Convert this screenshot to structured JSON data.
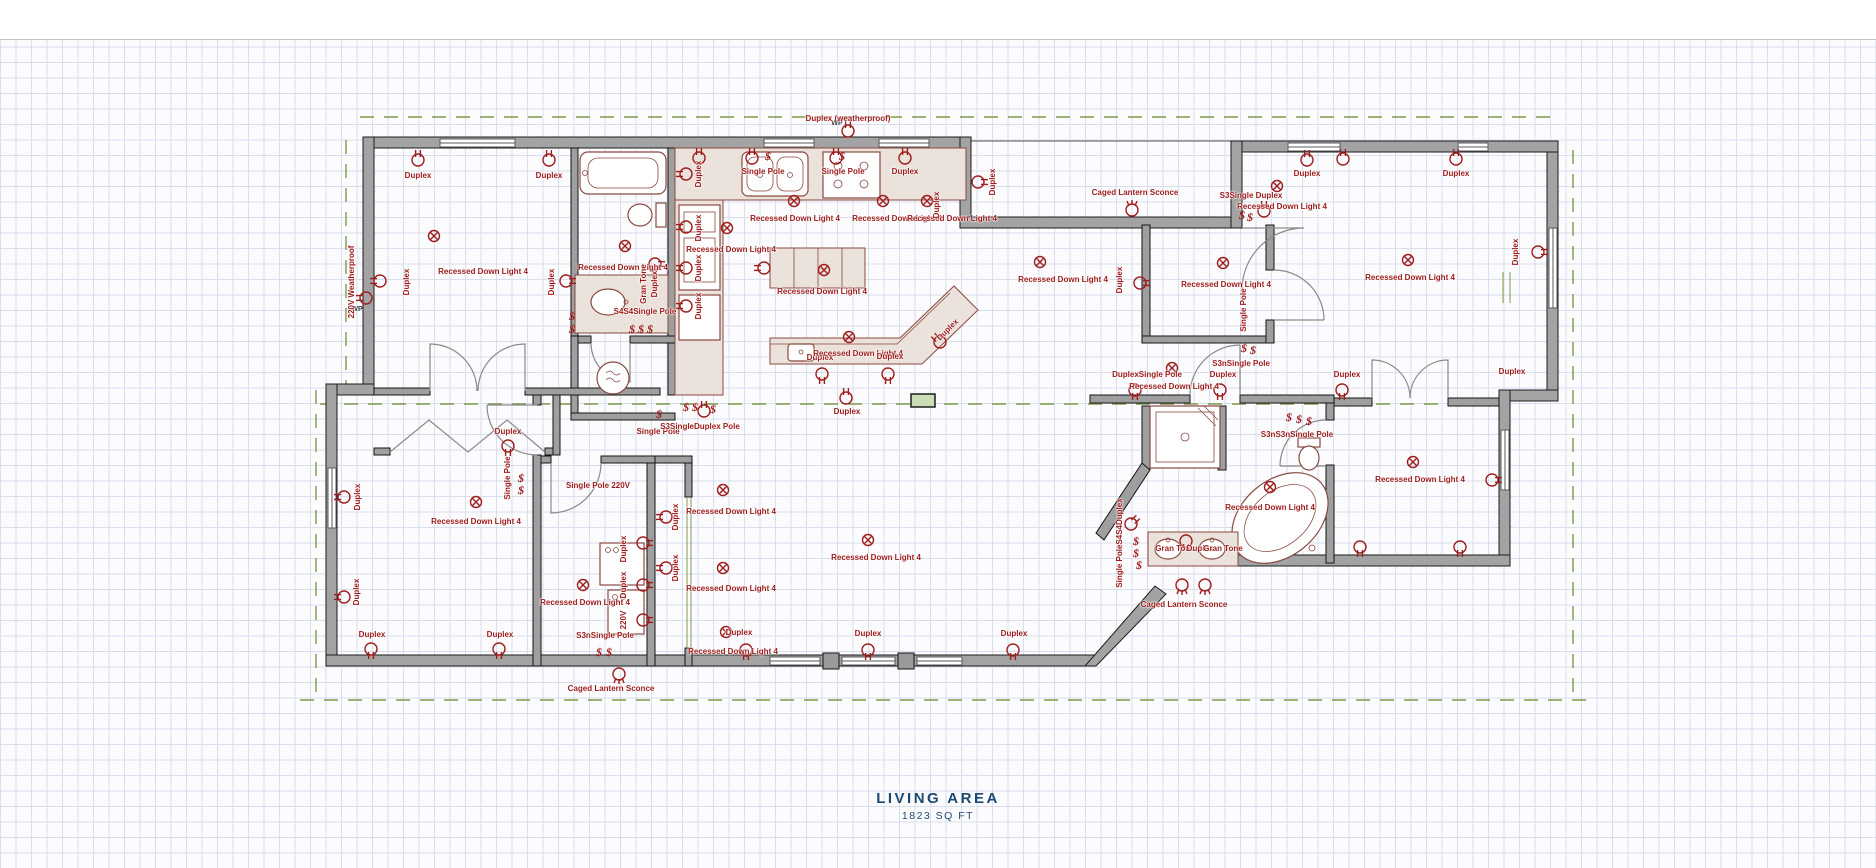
{
  "title": {
    "name": "LIVING AREA",
    "area": "1823 SQ FT"
  },
  "colors": {
    "annotation": "#9e1b1b",
    "title_blue": "#1d4a74",
    "wall_gray": "#a3a3a3",
    "grid": "#d9deec",
    "green_dash": "#7f9a48",
    "counter": "#eae2db"
  },
  "labels": [
    {
      "t": "Duplex",
      "x": 418,
      "y": 176,
      "r": 0
    },
    {
      "t": "Duplex",
      "x": 549,
      "y": 176,
      "r": 0
    },
    {
      "t": "Recessed Down Light 4",
      "x": 483,
      "y": 272,
      "r": 0
    },
    {
      "t": "Duplex",
      "x": 407,
      "y": 282,
      "r": -90
    },
    {
      "t": "Duplex",
      "x": 552,
      "y": 282,
      "r": -90
    },
    {
      "t": "220V Weatherproof",
      "x": 352,
      "y": 282,
      "r": -90
    },
    {
      "t": "Recessed Down Light 4",
      "x": 623,
      "y": 268,
      "r": 0
    },
    {
      "t": "Gran Tone",
      "x": 644,
      "y": 284,
      "r": -90
    },
    {
      "t": "Duplex",
      "x": 655,
      "y": 284,
      "r": -90
    },
    {
      "t": "S4S4Single Pole",
      "x": 645,
      "y": 312,
      "r": 0
    },
    {
      "t": "Duplex",
      "x": 699,
      "y": 174,
      "r": -90
    },
    {
      "t": "Single Pole",
      "x": 763,
      "y": 172,
      "r": 0
    },
    {
      "t": "Single Pole",
      "x": 843,
      "y": 172,
      "r": 0
    },
    {
      "t": "Duplex",
      "x": 905,
      "y": 172,
      "r": 0
    },
    {
      "t": "Duplex",
      "x": 993,
      "y": 182,
      "r": -90
    },
    {
      "t": "Recessed Down Light 4",
      "x": 795,
      "y": 219,
      "r": 0
    },
    {
      "t": "Recessed Down Light 4",
      "x": 897,
      "y": 219,
      "r": 0
    },
    {
      "t": "Recessed Down Light 4",
      "x": 952,
      "y": 219,
      "r": 0
    },
    {
      "t": "Duplex",
      "x": 937,
      "y": 205,
      "r": -90
    },
    {
      "t": "Duplex",
      "x": 699,
      "y": 228,
      "r": -90
    },
    {
      "t": "Duplex",
      "x": 699,
      "y": 268,
      "r": -90
    },
    {
      "t": "Duplex",
      "x": 699,
      "y": 306,
      "r": -90
    },
    {
      "t": "Recessed Down Light 4",
      "x": 731,
      "y": 250,
      "r": 0
    },
    {
      "t": "Recessed Down Light 4",
      "x": 822,
      "y": 292,
      "r": 0
    },
    {
      "t": "Duplex",
      "x": 820,
      "y": 358,
      "r": 0
    },
    {
      "t": "Recessed Down Light 4",
      "x": 858,
      "y": 354,
      "r": 0
    },
    {
      "t": "Duplex",
      "x": 890,
      "y": 357,
      "r": 0
    },
    {
      "t": "Duplex",
      "x": 948,
      "y": 330,
      "r": -45
    },
    {
      "t": "Duplex",
      "x": 847,
      "y": 412,
      "r": 0
    },
    {
      "t": "Recessed Down Light 4",
      "x": 1063,
      "y": 280,
      "r": 0
    },
    {
      "t": "Duplex",
      "x": 508,
      "y": 432,
      "r": 0
    },
    {
      "t": "Single Pole",
      "x": 508,
      "y": 478,
      "r": -90
    },
    {
      "t": "Single Pole",
      "x": 658,
      "y": 432,
      "r": 0
    },
    {
      "t": "S3SingleDuplex Pole",
      "x": 700,
      "y": 427,
      "r": 0
    },
    {
      "t": "Single Pole 220V",
      "x": 598,
      "y": 486,
      "r": 0
    },
    {
      "t": "Duplex",
      "x": 624,
      "y": 549,
      "r": -90
    },
    {
      "t": "Duplex",
      "x": 624,
      "y": 585,
      "r": -90
    },
    {
      "t": "220V",
      "x": 624,
      "y": 620,
      "r": -90
    },
    {
      "t": "Recessed Down Light 4",
      "x": 585,
      "y": 603,
      "r": 0
    },
    {
      "t": "S3nSingle Pole",
      "x": 605,
      "y": 636,
      "r": 0
    },
    {
      "t": "Caged Lantern Sconce",
      "x": 611,
      "y": 689,
      "r": 0
    },
    {
      "t": "Duplex",
      "x": 676,
      "y": 517,
      "r": -90
    },
    {
      "t": "Duplex",
      "x": 676,
      "y": 568,
      "r": -90
    },
    {
      "t": "Recessed Down Light 4",
      "x": 731,
      "y": 512,
      "r": 0
    },
    {
      "t": "Recessed Down Light 4",
      "x": 731,
      "y": 589,
      "r": 0
    },
    {
      "t": "Duplex",
      "x": 739,
      "y": 633,
      "r": 0
    },
    {
      "t": "Recessed Down Light 4",
      "x": 733,
      "y": 652,
      "r": 0
    },
    {
      "t": "Duplex",
      "x": 868,
      "y": 634,
      "r": 0
    },
    {
      "t": "Duplex",
      "x": 1014,
      "y": 634,
      "r": 0
    },
    {
      "t": "Recessed Down Light 4",
      "x": 876,
      "y": 558,
      "r": 0
    },
    {
      "t": "Single PoleS4S4Duplex",
      "x": 1120,
      "y": 543,
      "r": -90
    },
    {
      "t": "DuplexSingle Pole",
      "x": 1147,
      "y": 375,
      "r": 0
    },
    {
      "t": "Duplex",
      "x": 1223,
      "y": 375,
      "r": 0
    },
    {
      "t": "S3nSingle Pole",
      "x": 1241,
      "y": 364,
      "r": 0
    },
    {
      "t": "Duplex",
      "x": 1347,
      "y": 375,
      "r": 0
    },
    {
      "t": "Recessed Down Light 4",
      "x": 1174,
      "y": 387,
      "r": 0
    },
    {
      "t": "Single Pole",
      "x": 1244,
      "y": 310,
      "r": -90
    },
    {
      "t": "Recessed Down Light 4",
      "x": 1226,
      "y": 285,
      "r": 0
    },
    {
      "t": "Duplex",
      "x": 1120,
      "y": 280,
      "r": -90
    },
    {
      "t": "Caged Lantern Sconce",
      "x": 1135,
      "y": 193,
      "r": 0
    },
    {
      "t": "S3Single Duplex",
      "x": 1251,
      "y": 196,
      "r": 0
    },
    {
      "t": "Recessed Down Light 4",
      "x": 1282,
      "y": 207,
      "r": 0
    },
    {
      "t": "Duplex",
      "x": 1307,
      "y": 174,
      "r": 0
    },
    {
      "t": "Duplex",
      "x": 1456,
      "y": 174,
      "r": 0
    },
    {
      "t": "Recessed Down Light 4",
      "x": 1410,
      "y": 278,
      "r": 0
    },
    {
      "t": "Duplex",
      "x": 1516,
      "y": 252,
      "r": -90
    },
    {
      "t": "Duplex",
      "x": 1512,
      "y": 372,
      "r": 0
    },
    {
      "t": "S3nS3nSingle Pole",
      "x": 1297,
      "y": 435,
      "r": 0
    },
    {
      "t": "Recessed Down Light 4",
      "x": 1270,
      "y": 508,
      "r": 0
    },
    {
      "t": "Gran Tone",
      "x": 1175,
      "y": 549,
      "r": 0
    },
    {
      "t": "Duplex",
      "x": 1200,
      "y": 549,
      "r": 0
    },
    {
      "t": "Gran Tone",
      "x": 1223,
      "y": 549,
      "r": 0
    },
    {
      "t": "Caged Lantern Sconce",
      "x": 1184,
      "y": 605,
      "r": 0
    },
    {
      "t": "Recessed Down Light 4",
      "x": 1420,
      "y": 480,
      "r": 0
    },
    {
      "t": "Duplex",
      "x": 372,
      "y": 635,
      "r": 0
    },
    {
      "t": "Duplex",
      "x": 500,
      "y": 635,
      "r": 0
    },
    {
      "t": "Duplex",
      "x": 357,
      "y": 592,
      "r": -90
    },
    {
      "t": "Duplex",
      "x": 358,
      "y": 497,
      "r": -90
    },
    {
      "t": "Duplex (weatherproof)",
      "x": 848,
      "y": 119,
      "r": 0
    },
    {
      "t": "Recessed Down Light 4",
      "x": 476,
      "y": 522,
      "r": 0
    }
  ],
  "symbols": [
    {
      "k": "light",
      "x": 434,
      "y": 236,
      "r": 0
    },
    {
      "k": "duplex",
      "x": 418,
      "y": 160,
      "r": 0
    },
    {
      "k": "duplex",
      "x": 549,
      "y": 160,
      "r": 0
    },
    {
      "k": "duplex",
      "x": 380,
      "y": 281,
      "r": -90
    },
    {
      "k": "duplex",
      "x": 566,
      "y": 281,
      "r": 90
    },
    {
      "k": "duplex",
      "x": 366,
      "y": 298,
      "r": -90
    },
    {
      "k": "wp",
      "x": 357,
      "y": 309,
      "r": 0
    },
    {
      "k": "duplex",
      "x": 344,
      "y": 497,
      "r": -90
    },
    {
      "k": "duplex",
      "x": 344,
      "y": 597,
      "r": -90
    },
    {
      "k": "duplex",
      "x": 371,
      "y": 649,
      "r": 180
    },
    {
      "k": "duplex",
      "x": 499,
      "y": 649,
      "r": 180
    },
    {
      "k": "light",
      "x": 476,
      "y": 502,
      "r": 0
    },
    {
      "k": "duplex",
      "x": 508,
      "y": 446,
      "r": 180
    },
    {
      "k": "switch",
      "x": 521,
      "y": 478,
      "r": 0
    },
    {
      "k": "switch",
      "x": 521,
      "y": 490,
      "r": 0
    },
    {
      "k": "switch",
      "x": 572,
      "y": 316,
      "r": 0
    },
    {
      "k": "switch",
      "x": 572,
      "y": 329,
      "r": 0
    },
    {
      "k": "light",
      "x": 625,
      "y": 246,
      "r": 0
    },
    {
      "k": "duplex",
      "x": 655,
      "y": 264,
      "r": 90
    },
    {
      "k": "switch",
      "x": 632,
      "y": 329,
      "r": 0
    },
    {
      "k": "switch",
      "x": 641,
      "y": 329,
      "r": 0
    },
    {
      "k": "switch",
      "x": 650,
      "y": 329,
      "r": 0
    },
    {
      "k": "duplex",
      "x": 699,
      "y": 158,
      "r": 0
    },
    {
      "k": "duplex",
      "x": 752,
      "y": 158,
      "r": 0
    },
    {
      "k": "switch",
      "x": 768,
      "y": 156,
      "r": 0
    },
    {
      "k": "duplex",
      "x": 836,
      "y": 158,
      "r": 0
    },
    {
      "k": "switch",
      "x": 842,
      "y": 156,
      "r": 0
    },
    {
      "k": "duplex",
      "x": 905,
      "y": 158,
      "r": 0
    },
    {
      "k": "duplex",
      "x": 686,
      "y": 174,
      "r": -90
    },
    {
      "k": "duplex",
      "x": 686,
      "y": 227,
      "r": -90
    },
    {
      "k": "duplex",
      "x": 686,
      "y": 268,
      "r": -90
    },
    {
      "k": "duplex",
      "x": 686,
      "y": 306,
      "r": -90
    },
    {
      "k": "light",
      "x": 794,
      "y": 201,
      "r": 0
    },
    {
      "k": "light",
      "x": 883,
      "y": 201,
      "r": 0
    },
    {
      "k": "light",
      "x": 927,
      "y": 201,
      "r": 0
    },
    {
      "k": "light",
      "x": 727,
      "y": 228,
      "r": 0
    },
    {
      "k": "duplex",
      "x": 978,
      "y": 182,
      "r": 90
    },
    {
      "k": "light",
      "x": 824,
      "y": 270,
      "r": 0
    },
    {
      "k": "duplex",
      "x": 764,
      "y": 268,
      "r": -90
    },
    {
      "k": "light",
      "x": 849,
      "y": 337,
      "r": 0
    },
    {
      "k": "duplex",
      "x": 822,
      "y": 374,
      "r": 180
    },
    {
      "k": "duplex",
      "x": 888,
      "y": 374,
      "r": 180
    },
    {
      "k": "duplex",
      "x": 940,
      "y": 342,
      "r": -45
    },
    {
      "k": "duplex",
      "x": 846,
      "y": 398,
      "r": 0
    },
    {
      "k": "light",
      "x": 1040,
      "y": 262,
      "r": 0
    },
    {
      "k": "duplex",
      "x": 848,
      "y": 131,
      "r": 0
    },
    {
      "k": "wp",
      "x": 837,
      "y": 123,
      "r": 0
    },
    {
      "k": "switch",
      "x": 659,
      "y": 414,
      "r": 0
    },
    {
      "k": "switch",
      "x": 686,
      "y": 407,
      "r": 0
    },
    {
      "k": "switch",
      "x": 695,
      "y": 407,
      "r": 0
    },
    {
      "k": "duplex",
      "x": 704,
      "y": 411,
      "r": 0
    },
    {
      "k": "switch",
      "x": 713,
      "y": 409,
      "r": 0
    },
    {
      "k": "light",
      "x": 583,
      "y": 585,
      "r": 0
    },
    {
      "k": "duplex",
      "x": 643,
      "y": 543,
      "r": 90
    },
    {
      "k": "duplex",
      "x": 643,
      "y": 585,
      "r": 90
    },
    {
      "k": "duplex",
      "x": 643,
      "y": 620,
      "r": 90
    },
    {
      "k": "switch",
      "x": 599,
      "y": 652,
      "r": 0
    },
    {
      "k": "switch",
      "x": 609,
      "y": 652,
      "r": 0
    },
    {
      "k": "sconce",
      "x": 619,
      "y": 674,
      "r": 180
    },
    {
      "k": "duplex",
      "x": 666,
      "y": 517,
      "r": -90
    },
    {
      "k": "duplex",
      "x": 666,
      "y": 568,
      "r": -90
    },
    {
      "k": "light",
      "x": 723,
      "y": 490,
      "r": 0
    },
    {
      "k": "light",
      "x": 723,
      "y": 568,
      "r": 0
    },
    {
      "k": "light",
      "x": 726,
      "y": 632,
      "r": 0
    },
    {
      "k": "duplex",
      "x": 746,
      "y": 650,
      "r": 180
    },
    {
      "k": "duplex",
      "x": 868,
      "y": 650,
      "r": 180
    },
    {
      "k": "duplex",
      "x": 1013,
      "y": 650,
      "r": 180
    },
    {
      "k": "light",
      "x": 868,
      "y": 540,
      "r": 0
    },
    {
      "k": "duplex",
      "x": 1131,
      "y": 524,
      "r": 45
    },
    {
      "k": "switch",
      "x": 1136,
      "y": 541,
      "r": 0
    },
    {
      "k": "switch",
      "x": 1136,
      "y": 553,
      "r": 0
    },
    {
      "k": "switch",
      "x": 1139,
      "y": 565,
      "r": 0
    },
    {
      "k": "duplex",
      "x": 1135,
      "y": 390,
      "r": 180
    },
    {
      "k": "duplex",
      "x": 1220,
      "y": 390,
      "r": 180
    },
    {
      "k": "duplex",
      "x": 1342,
      "y": 390,
      "r": 180
    },
    {
      "k": "light",
      "x": 1172,
      "y": 368,
      "r": 0
    },
    {
      "k": "switch",
      "x": 1244,
      "y": 348,
      "r": 0
    },
    {
      "k": "switch",
      "x": 1253,
      "y": 350,
      "r": 0
    },
    {
      "k": "light",
      "x": 1223,
      "y": 263,
      "r": 0
    },
    {
      "k": "duplex",
      "x": 1140,
      "y": 283,
      "r": 90
    },
    {
      "k": "sconce",
      "x": 1132,
      "y": 210,
      "r": 0
    },
    {
      "k": "switch",
      "x": 1242,
      "y": 215,
      "r": 0
    },
    {
      "k": "switch",
      "x": 1250,
      "y": 217,
      "r": 0
    },
    {
      "k": "duplex",
      "x": 1264,
      "y": 211,
      "r": 0
    },
    {
      "k": "light",
      "x": 1277,
      "y": 186,
      "r": 0
    },
    {
      "k": "light",
      "x": 1408,
      "y": 260,
      "r": 0
    },
    {
      "k": "duplex",
      "x": 1307,
      "y": 160,
      "r": 0
    },
    {
      "k": "duplex",
      "x": 1343,
      "y": 159,
      "r": 0
    },
    {
      "k": "duplex",
      "x": 1456,
      "y": 159,
      "r": 0
    },
    {
      "k": "duplex",
      "x": 1538,
      "y": 252,
      "r": 90
    },
    {
      "k": "switch",
      "x": 1289,
      "y": 417,
      "r": 0
    },
    {
      "k": "switch",
      "x": 1299,
      "y": 419,
      "r": 0
    },
    {
      "k": "switch",
      "x": 1309,
      "y": 421,
      "r": 0
    },
    {
      "k": "light",
      "x": 1270,
      "y": 487,
      "r": 0
    },
    {
      "k": "duplex",
      "x": 1186,
      "y": 541,
      "r": 180
    },
    {
      "k": "sconce",
      "x": 1182,
      "y": 585,
      "r": 180
    },
    {
      "k": "sconce",
      "x": 1205,
      "y": 585,
      "r": 180
    },
    {
      "k": "light",
      "x": 1413,
      "y": 462,
      "r": 0
    },
    {
      "k": "duplex",
      "x": 1360,
      "y": 547,
      "r": 180
    },
    {
      "k": "duplex",
      "x": 1460,
      "y": 547,
      "r": 180
    },
    {
      "k": "duplex",
      "x": 1492,
      "y": 480,
      "r": 90
    }
  ]
}
